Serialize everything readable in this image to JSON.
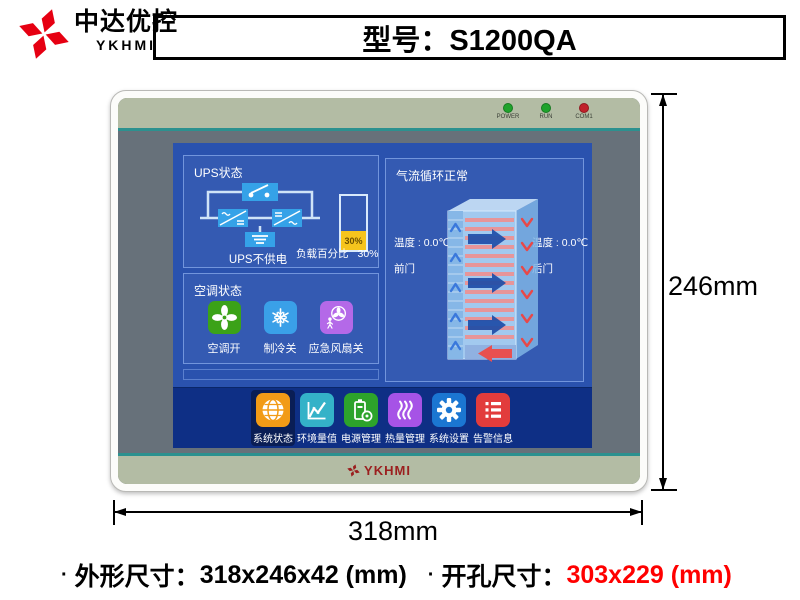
{
  "header": {
    "brand_cn": "中达优控",
    "brand_en": "YKHMI",
    "model_label": "型号：S1200QA"
  },
  "device": {
    "leds": [
      {
        "label": "POWER",
        "color": "#1fa32c"
      },
      {
        "label": "RUN",
        "color": "#1fa32c"
      },
      {
        "label": "COM1",
        "color": "#c0202a"
      }
    ],
    "bottom_brand": "YKHMI",
    "screen": {
      "ups": {
        "title": "UPS状态",
        "status": "UPS不供电",
        "bar_value": "30%",
        "load_label": "负载百分比",
        "load_value": "30%",
        "load_percent": 30,
        "bar_fill_color": "#f6c41d"
      },
      "ac": {
        "title": "空调状态",
        "items": [
          {
            "label": "空调开",
            "icon": "fan-icon",
            "color": "#3ba218"
          },
          {
            "label": "制冷关",
            "icon": "snowflake-icon",
            "color": "#3aa0e8"
          },
          {
            "label": "应急风扇关",
            "icon": "emergency-fan-icon",
            "color": "#b469e8"
          }
        ]
      },
      "airflow": {
        "title": "气流循环正常",
        "front_temp": "温度 : 0.0℃",
        "front_door": "前门",
        "rear_temp": "温度 : 0.0℃",
        "rear_door": "后门"
      },
      "toolbar": [
        {
          "label": "系统状态",
          "icon": "globe-status-icon",
          "color": "#f29b16",
          "selected": true
        },
        {
          "label": "环境量值",
          "icon": "chart-icon",
          "color": "#34b2c8",
          "selected": false
        },
        {
          "label": "电源管理",
          "icon": "battery-icon",
          "color": "#2da32b",
          "selected": false
        },
        {
          "label": "热量管理",
          "icon": "heat-icon",
          "color": "#a653e6",
          "selected": false
        },
        {
          "label": "系统设置",
          "icon": "gear-icon",
          "color": "#1b76d2",
          "selected": false
        },
        {
          "label": "告警信息",
          "icon": "numbered-list-icon",
          "color": "#e23c3c",
          "selected": false
        }
      ],
      "colors": {
        "screen_blue": "#2a52ae",
        "toolbar_blue": "#0e2f85",
        "selected_tool_bg": "#0a1e55"
      }
    },
    "colors": {
      "strip_green": "#b3bca4",
      "teal_line": "#2c918f",
      "bezel_gray": "#67717a"
    }
  },
  "dimensions": {
    "height_label": "246mm",
    "width_label": "318mm"
  },
  "footer": {
    "bullet": "·",
    "outline_label": "外形尺寸：",
    "outline_value": "318x246x42 (mm)",
    "cutout_label": "开孔尺寸：",
    "cutout_value": "303x229 (mm)",
    "cutout_color": "#ff0000"
  }
}
